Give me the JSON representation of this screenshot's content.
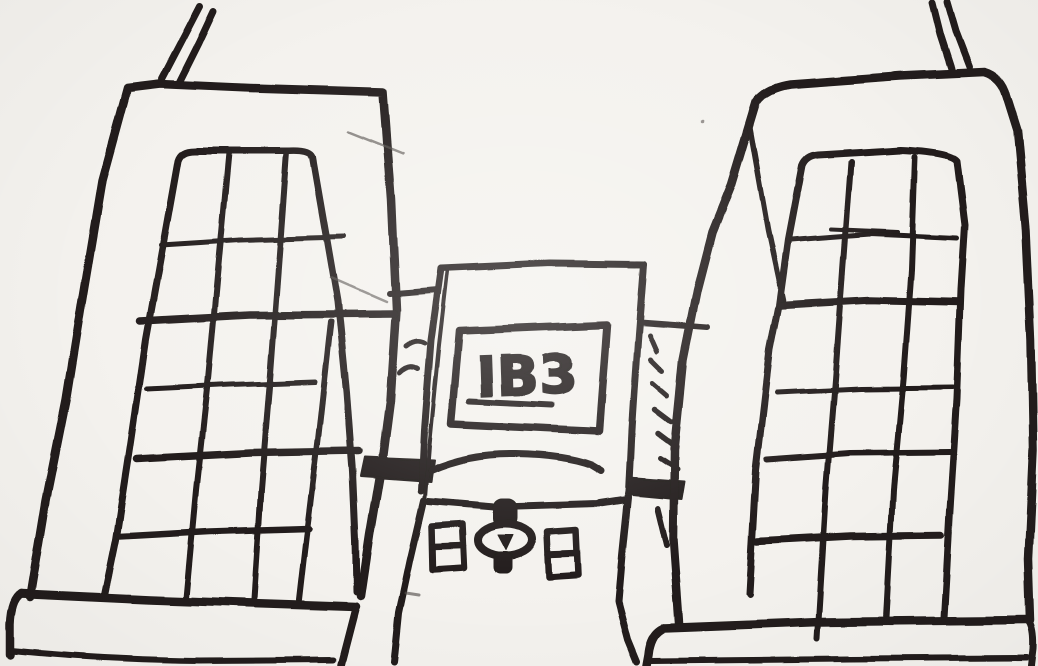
{
  "scene": {
    "description": "Hand-drawn black ink sketch: two tall tower buildings with rooftop antennas and large gridded windows flank a smaller central building that bears an IB3 sign above an arched entrance with a column and two small paned windows",
    "paper_color": "#f4f2ee",
    "ink_color": "#201d1a"
  },
  "sign": {
    "text": "IB3"
  }
}
